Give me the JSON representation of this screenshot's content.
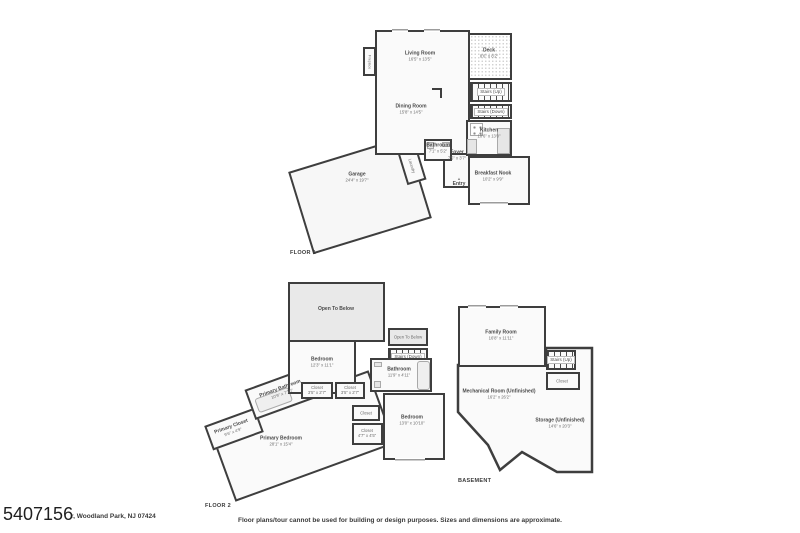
{
  "page": {
    "listing_id": "5407156",
    "address_fragment": "r, Woodland Park, NJ 07424",
    "disclaimer": "Floor plans/tour cannot be used for building or design purposes. Sizes and dimensions are approximate."
  },
  "icons": {
    "entry_marker": "▲"
  },
  "colors": {
    "wall": "#3e3e3e",
    "room_fill": "#fafafa",
    "shaded_fill": "#e9e9e9",
    "text": "#4a4a4a"
  },
  "floor1": {
    "title": "FLOOR 1",
    "living": {
      "name": "Living Room",
      "dims": "16'5\" x 13'5\""
    },
    "dining": {
      "name": "Dining Room",
      "dims": "15'8\" x 14'5\""
    },
    "deck": {
      "name": "Deck",
      "dims": "8'6\" x 8'2\""
    },
    "stairs_up": {
      "name": "Stairs (Up)"
    },
    "stairs_down": {
      "name": "Stairs (Down)"
    },
    "kitchen": {
      "name": "Kitchen",
      "dims": "10'6\" x 13'0\""
    },
    "bathroom": {
      "name": "Bathroom",
      "dims": "7'1\" x 5'2\""
    },
    "foyer": {
      "name": "Foyer",
      "dims": "7'5\" x 3'7\""
    },
    "breakfast_nook": {
      "name": "Breakfast Nook",
      "dims": "10'2\" x 9'9\""
    },
    "entry": {
      "name": "Entry"
    },
    "laundry": {
      "name": "Laundry"
    },
    "fireplace": {
      "name": "Fireplace"
    },
    "garage": {
      "name": "Garage",
      "dims": "24'4\" x 19'7\""
    }
  },
  "floor2": {
    "title": "FLOOR 2",
    "open_below_large": {
      "name": "Open To Below"
    },
    "open_below_small": {
      "name": "Open To Below"
    },
    "stairs_down": {
      "name": "Stairs (Down)"
    },
    "bedroom": {
      "name": "Bedroom",
      "dims": "12'3\" x 11'1\""
    },
    "bathroom": {
      "name": "Bathroom",
      "dims": "11'9\" x 4'11\""
    },
    "closet_a": {
      "name": "Closet",
      "dims": "3'5\" x 2'7\""
    },
    "closet_b": {
      "name": "Closet",
      "dims": "3'5\" x 2'7\""
    },
    "primary_bathroom": {
      "name": "Primary Bathroom",
      "dims": "10'9\" x 7'10\""
    },
    "primary_closet": {
      "name": "Primary Closet",
      "dims": "9'6\" x 4'9\""
    },
    "primary_bedroom": {
      "name": "Primary Bedroom",
      "dims": "28'1\" x 15'4\""
    },
    "closet_hall": {
      "name": "Closet"
    },
    "closet_c": {
      "name": "Closet",
      "dims": "4'7\" x 4'5\""
    },
    "bedroom2": {
      "name": "Bedroom",
      "dims": "13'0\" x 10'10\""
    }
  },
  "basement": {
    "title": "BASEMENT",
    "family_room": {
      "name": "Family Room",
      "dims": "16'8\" x 11'11\""
    },
    "stairs_up": {
      "name": "Stairs (Up)"
    },
    "closet": {
      "name": "Closet"
    },
    "mechanical": {
      "name": "Mechanical Room (Unfinished)",
      "dims": "16'2\" x 26'2\""
    },
    "storage": {
      "name": "Storage (Unfinished)",
      "dims": "14'6\" x 20'3\""
    }
  }
}
